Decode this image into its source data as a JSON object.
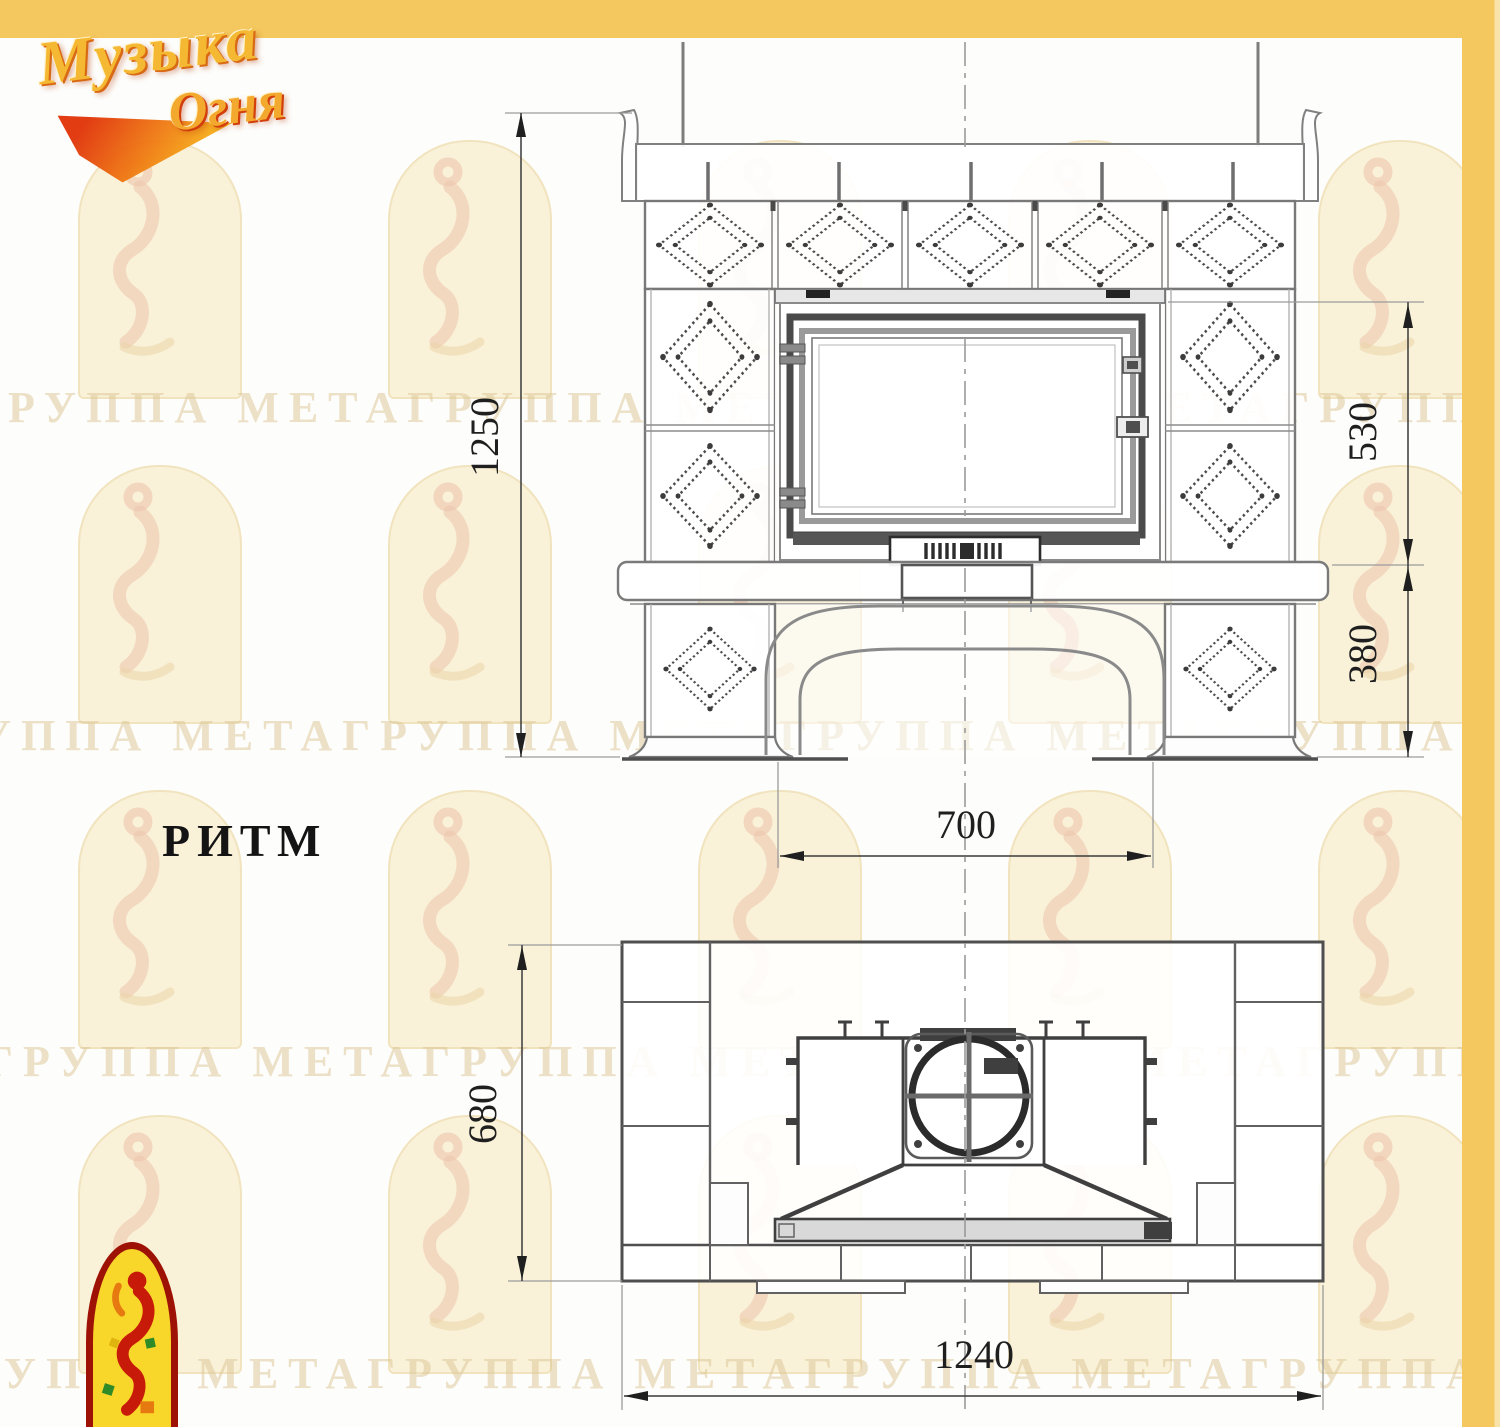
{
  "page": {
    "background": "#fdfdfb",
    "accent_yellow": "#f4c85e",
    "line_gray": "#8a8a8a",
    "dark_gray": "#4a4a4a",
    "dim_text_color": "#1f1f1f"
  },
  "brand": {
    "logo_line1": "Музыка",
    "logo_line2": "Огня"
  },
  "model": {
    "title": "РИТМ"
  },
  "watermark": {
    "text": "ГРУППА МЕТАГРУППА МЕТАГРУППА МЕТАГРУППА МЕТАГРУППА МЕТА"
  },
  "front_view": {
    "label": "front elevation",
    "dims": {
      "overall_height": "1250",
      "firebox_section_height": "530",
      "base_section_height": "380",
      "arch_opening_width": "700"
    }
  },
  "plan_view": {
    "label": "top view",
    "dims": {
      "overall_depth": "680",
      "overall_width": "1240"
    }
  }
}
